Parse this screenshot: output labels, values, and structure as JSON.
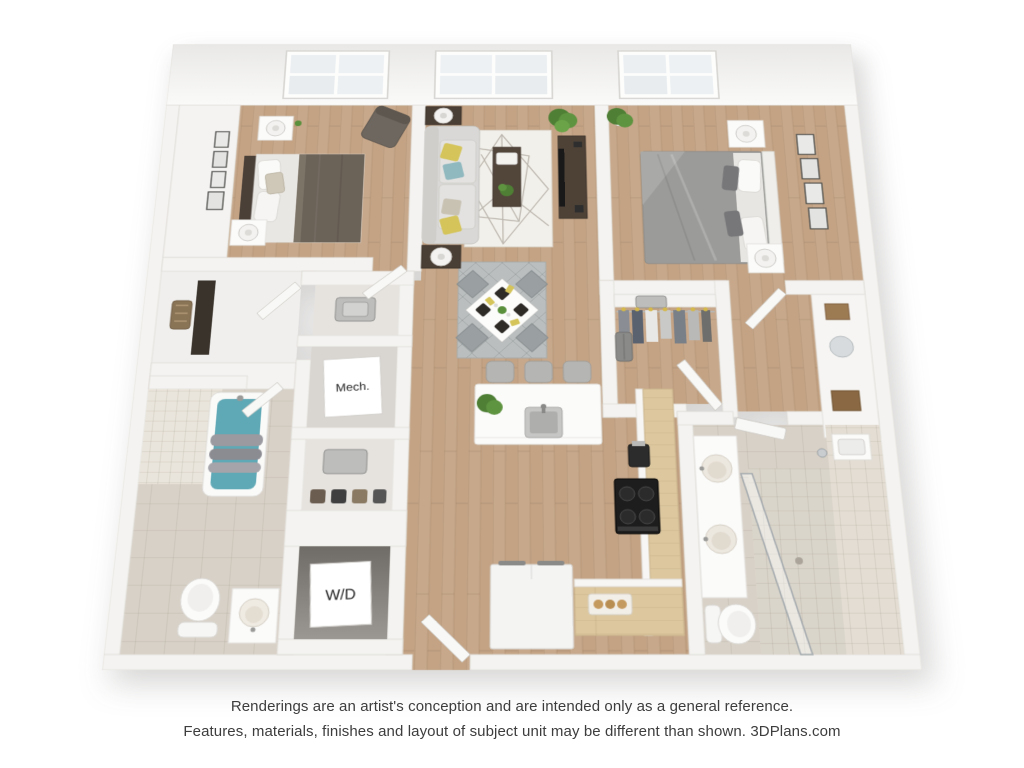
{
  "labels": {
    "mech": "Mech.",
    "washer_dryer": "W/D"
  },
  "caption": {
    "line1": "Renderings are an artist's conception and are intended only as a general reference.",
    "line2": "Features, materials, finishes and layout of subject unit may be different than shown. 3DPlans.com"
  },
  "colors": {
    "wood": "#c3a384",
    "wood_counter": "#dcc79f",
    "tile": "#d8d1c7",
    "small_tile": "#eae5dc",
    "shower_tile": "#e3ddd3",
    "wall": "#f4f3f1",
    "teal": "#5fa8b5",
    "yellow": "#d4c45a",
    "green": "#5a8f3c",
    "rug_living": "#f2f0ea",
    "rug_dining": "#babebe",
    "bed_gray": "#9b9b99",
    "blanket_brown": "#6b6258"
  }
}
